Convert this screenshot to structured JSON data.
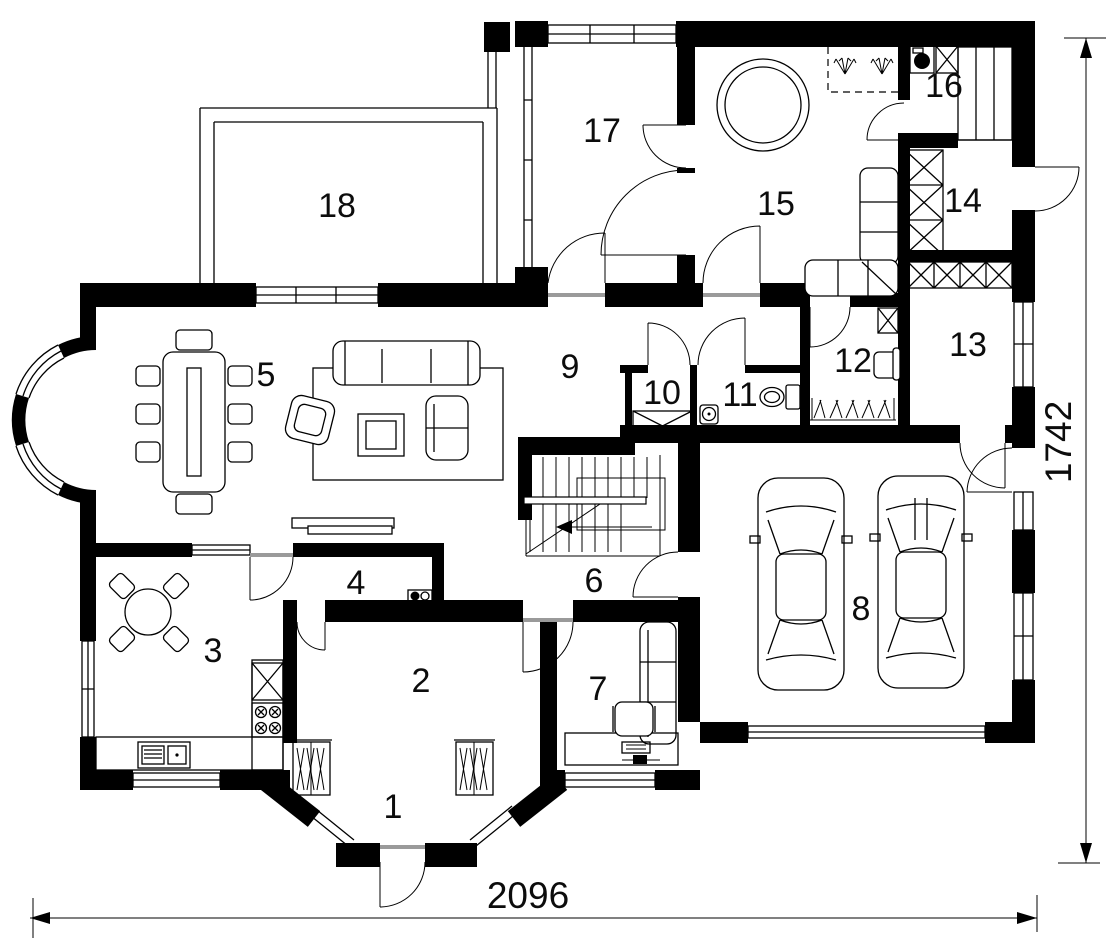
{
  "floor_plan": {
    "kind": "single-storey house plan",
    "colors": {
      "wall": "#000000",
      "background": "#ffffff",
      "line": "#0c0c0c"
    },
    "room_labels": [
      {
        "number": "1",
        "x": 393,
        "y": 818
      },
      {
        "number": "2",
        "x": 421,
        "y": 692
      },
      {
        "number": "3",
        "x": 213,
        "y": 662
      },
      {
        "number": "4",
        "x": 356,
        "y": 594
      },
      {
        "number": "5",
        "x": 266,
        "y": 386
      },
      {
        "number": "6",
        "x": 594,
        "y": 592
      },
      {
        "number": "7",
        "x": 598,
        "y": 700
      },
      {
        "number": "8",
        "x": 861,
        "y": 620
      },
      {
        "number": "9",
        "x": 570,
        "y": 378
      },
      {
        "number": "10",
        "x": 662,
        "y": 404
      },
      {
        "number": "11",
        "x": 740,
        "y": 406
      },
      {
        "number": "12",
        "x": 853,
        "y": 372
      },
      {
        "number": "13",
        "x": 968,
        "y": 356
      },
      {
        "number": "14",
        "x": 963,
        "y": 212
      },
      {
        "number": "15",
        "x": 776,
        "y": 215
      },
      {
        "number": "16",
        "x": 944,
        "y": 97
      },
      {
        "number": "17",
        "x": 602,
        "y": 142
      },
      {
        "number": "18",
        "x": 337,
        "y": 217
      }
    ],
    "dimensions": {
      "width": {
        "label": "2096",
        "x": 528,
        "y": 908
      },
      "height": {
        "label": "1742",
        "x": 1071,
        "y": 442,
        "rotation": -90
      }
    },
    "icons": [
      "dining-table",
      "dining-chair",
      "sofa-3seat",
      "sofa-2seat",
      "armchair",
      "coffee-table",
      "rug",
      "sideboard",
      "corner-sofa",
      "hot-tub",
      "sauna-zone",
      "shower-spray",
      "washing-machine",
      "shaft-x-box",
      "closet-shelves",
      "wardrobe-hangers",
      "clothes-rail",
      "toilet",
      "hand-basin",
      "round-table",
      "kitchen-counter",
      "kitchen-sink",
      "stove",
      "fridge",
      "staircase",
      "stairs-direction-arrow",
      "car",
      "desk",
      "office-chair",
      "keyboard",
      "printer",
      "window",
      "door",
      "terrace-outline",
      "dimension-line"
    ]
  }
}
